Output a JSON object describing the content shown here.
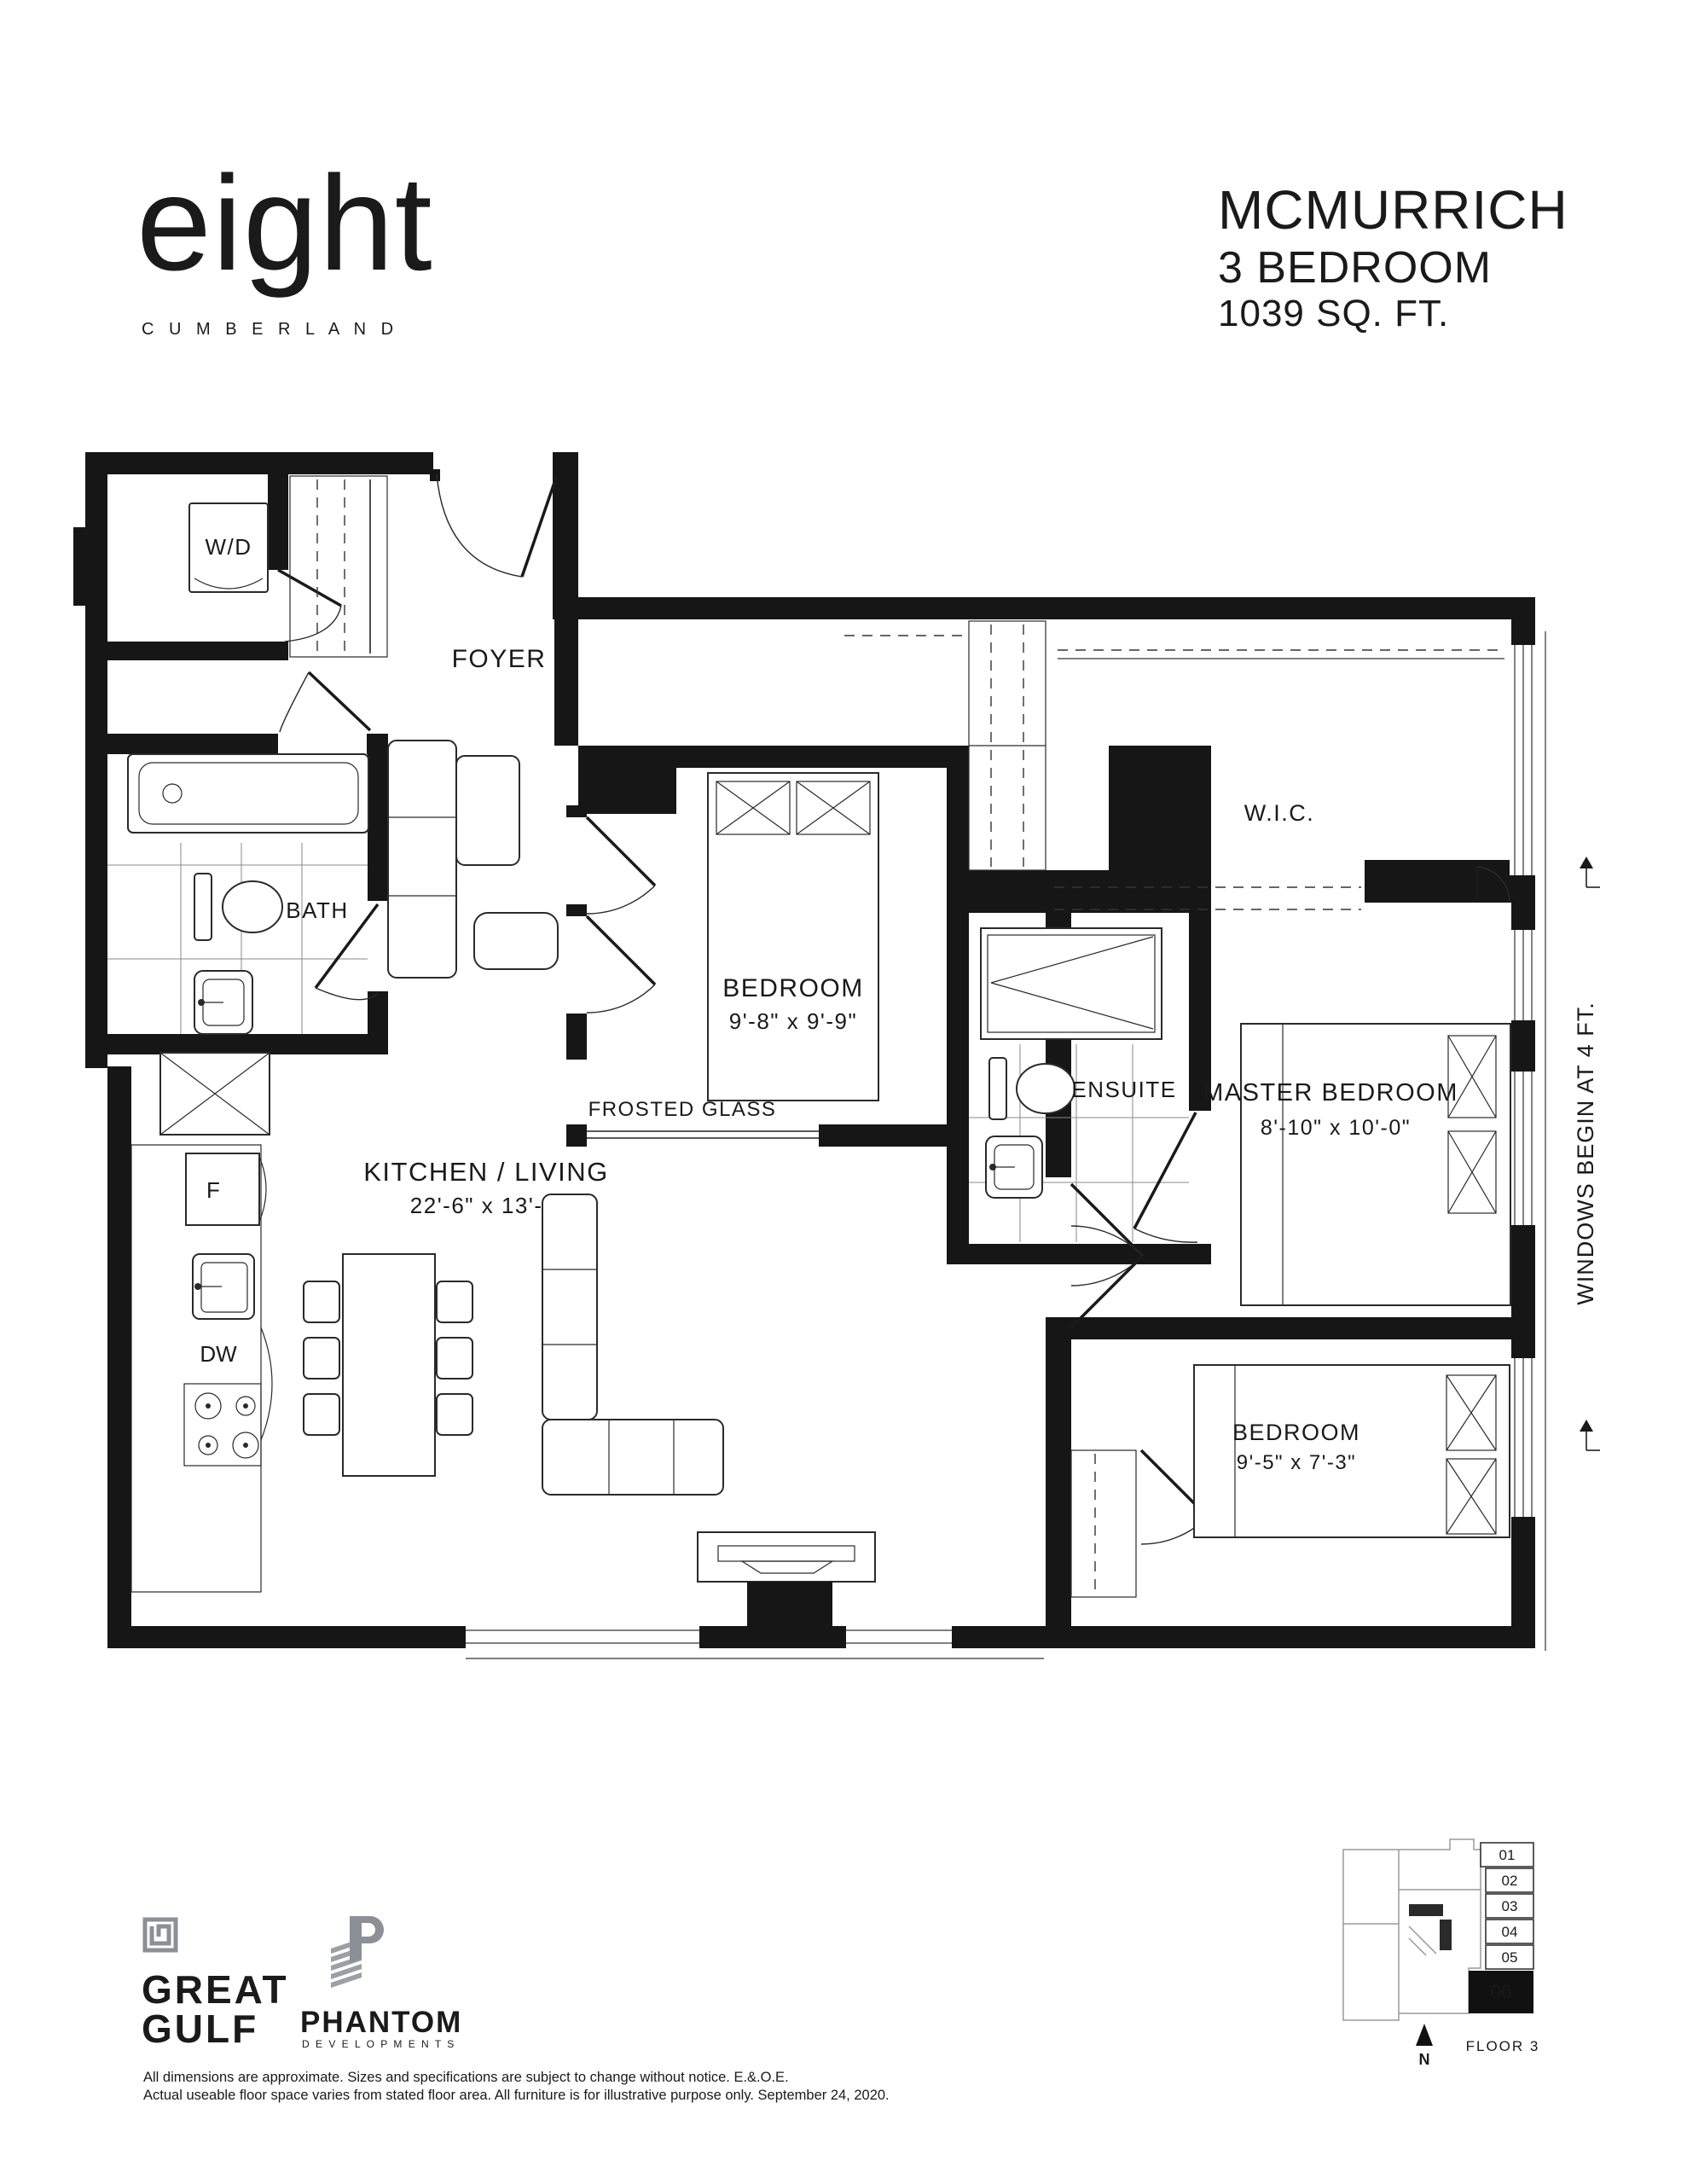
{
  "branding": {
    "logo_word": "eight",
    "logo_sub": "C U M B E R L A N D",
    "logo_gold": "#95813E",
    "gold": "#97824A",
    "gold_dark": "#8E7B41",
    "gold_light": "#AC9960"
  },
  "title": {
    "name": "MCMURRICH",
    "type": "3 BEDROOM",
    "area": "1039 SQ. FT."
  },
  "rooms": {
    "foyer": {
      "label": "FOYER"
    },
    "wd": {
      "label": "W/D"
    },
    "bath": {
      "label": "BATH"
    },
    "bedroom2": {
      "label": "BEDROOM",
      "dims": "9'-8\" x 9'-9\""
    },
    "wic": {
      "label": "W.I.C."
    },
    "ensuite": {
      "label": "ENSUITE"
    },
    "master": {
      "label": "MASTER BEDROOM",
      "dims": "8'-10\" x 10'-0\""
    },
    "kitchen": {
      "label": "KITCHEN / LIVING",
      "dims": "22'-6\" x 13'-2\""
    },
    "bedroom3": {
      "label": "BEDROOM",
      "dims": "9'-5\" x 7'-3\""
    },
    "frosted": {
      "label": "FROSTED GLASS"
    },
    "fridge": {
      "label": "F"
    },
    "dishwasher": {
      "label": "DW"
    }
  },
  "notes": {
    "windows": "WINDOWS BEGIN AT 4 FT."
  },
  "keyplan": {
    "units": [
      "01",
      "02",
      "03",
      "04",
      "05",
      "06"
    ],
    "highlight": "06",
    "floor": "FLOOR 3",
    "north": "N"
  },
  "developers": {
    "gg_line1": "GREAT",
    "gg_line2": "GULF",
    "phantom": "PHANTOM",
    "phantom_sub": "D E V E L O P M E N T S"
  },
  "disclaimer": [
    "All dimensions are approximate. Sizes and specifications are subject to change without notice. E.&.O.E.",
    "Actual useable floor space varies from stated floor area. All furniture is for illustrative purpose only. September 24, 2020."
  ]
}
